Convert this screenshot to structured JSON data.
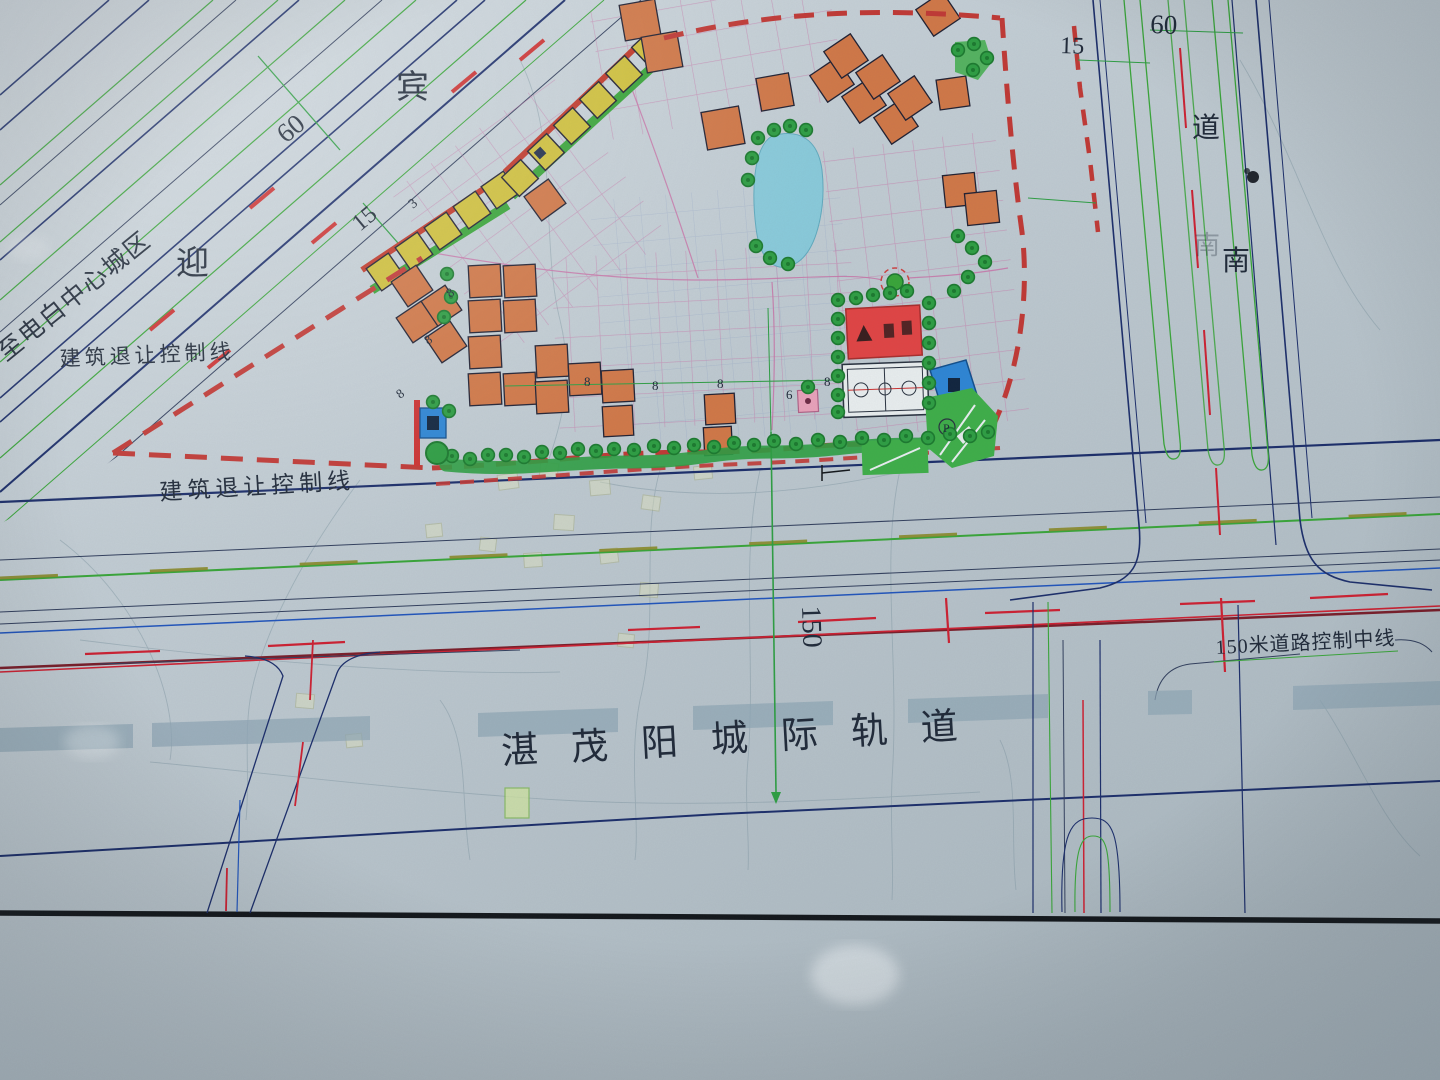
{
  "map": {
    "labels": {
      "rail_line": "湛茂阳城际轨道",
      "setback_upper": "建筑退让控制线",
      "setback_lower": "建筑退让控制线",
      "road_control_centerline": "150米道路控制中线",
      "to_dianbai_center": "至电白中心城区",
      "avenue_char_ying": "迎",
      "avenue_char_bin": "宾",
      "road_char_dao": "道",
      "road_char_nan": "南",
      "parking_symbol": "P"
    },
    "dimensions": {
      "left_road_width": "60",
      "left_setback": "15",
      "left_small": "3",
      "right_setback": "15",
      "right_road_width": "60",
      "corridor_width": "150",
      "lot_dims": [
        {
          "v": "8"
        },
        {
          "v": "8"
        },
        {
          "v": "8"
        },
        {
          "v": "8"
        },
        {
          "v": "6"
        },
        {
          "v": "8"
        },
        {
          "v": "8"
        },
        {
          "v": "8"
        }
      ]
    },
    "legend_colors": {
      "boundary_red": "#c03a36",
      "residential_yellow": "#cfc03d",
      "residential_orange": "#d07848",
      "water_blue": "#85cadb",
      "green_space": "#3fae4a",
      "grid_magenta": "#c871a6",
      "control_line_navy": "#1d2f6b",
      "rail_gray": "#8fa6b4"
    }
  }
}
